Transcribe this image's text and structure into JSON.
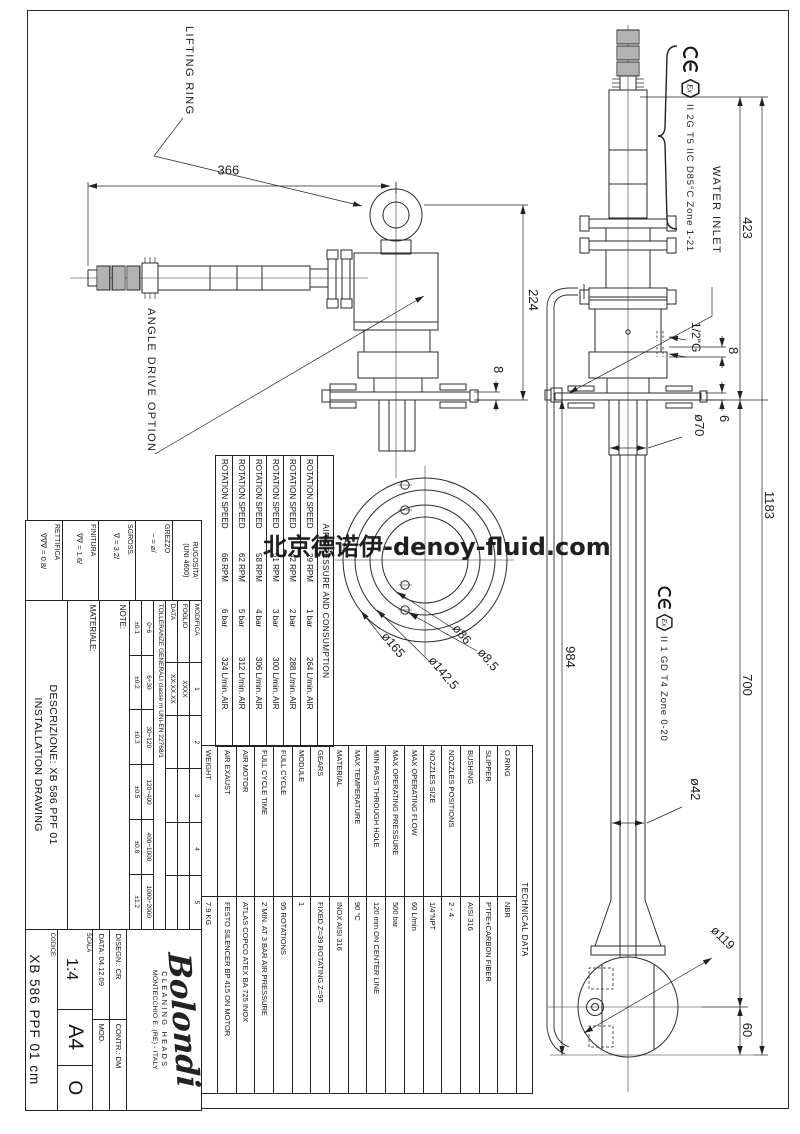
{
  "watermark": "北京德诺伊-denoy-fluid.com",
  "annotations": {
    "lifting_ring": "LIFTING RING",
    "angle_drive": "ANGLE DRIVE OPTION",
    "water_inlet": "WATER INLET",
    "atex_motor": "II 2G T5 IIC D85°C Zone 1-21",
    "atex_head": "II 1 GD T4 Zone 0-20",
    "ex_label": "Ex"
  },
  "dimensions": {
    "d1183": "1183",
    "d423": "423",
    "d700": "700",
    "d60": "60",
    "d984": "984",
    "d366": "366",
    "d224": "224",
    "d8l": "8",
    "d8r": "8",
    "d6": "6",
    "d70": "ø70",
    "g12": "1/2\"G",
    "d42": "ø42",
    "d119": "ø119",
    "d85": "ø8.5",
    "d86": "ø86",
    "d142": "ø142.5",
    "d165": "ø165"
  },
  "air_table": {
    "title": "AIR PRESSURE AND CONSUMPTION",
    "rows": [
      {
        "label": "ROTATION SPEED",
        "speed": "29 RPM",
        "pressure": "1 bar",
        "flow": "264 L/min. AIR"
      },
      {
        "label": "ROTATION SPEED",
        "speed": "42 RPM",
        "pressure": "2 bar",
        "flow": "288 L/min. AIR"
      },
      {
        "label": "ROTATION SPEED",
        "speed": "51 RPM",
        "pressure": "3 bar",
        "flow": "300 L/min. AIR"
      },
      {
        "label": "ROTATION SPEED",
        "speed": "58 RPM",
        "pressure": "4 bar",
        "flow": "306 L/min. AIR"
      },
      {
        "label": "ROTATION SPEED",
        "speed": "62 RPM",
        "pressure": "5 bar",
        "flow": "312 L/min. AIR"
      },
      {
        "label": "ROTATION SPEED",
        "speed": "66 RPM",
        "pressure": "6 bar",
        "flow": "324 L/min. AIR"
      }
    ]
  },
  "tech_table": {
    "title": "TECHNICAL DATA",
    "rows": [
      {
        "k": "O.RING",
        "v": "NBR"
      },
      {
        "k": "SLIPPER",
        "v": "PTFE+CARBON FIBER"
      },
      {
        "k": "BUSHING",
        "v": "AISI 316"
      },
      {
        "k": "NOZZLES POSITIONS",
        "v": "2 - 4"
      },
      {
        "k": "NOZZLES SIZE",
        "v": "1/4\"NPT"
      },
      {
        "k": "MAX OPERATING FLOW",
        "v": "60 L/min"
      },
      {
        "k": "MAX OPERATING PRESSURE",
        "v": "500 bar"
      },
      {
        "k": "MIN PASS THROUGH HOLE",
        "v": "120 mm ON CENTER LINE"
      },
      {
        "k": "MAX TEMPERATURE",
        "v": "90 °C"
      },
      {
        "k": "MATERIAL",
        "v": "INOX AISI 316"
      },
      {
        "k": "GEARS",
        "v": "FIXED Z=39 ROTATING Z=95"
      },
      {
        "k": "MODULE",
        "v": "1"
      },
      {
        "k": "FULL CYCLE",
        "v": "95 ROTATIONS"
      },
      {
        "k": "FULL CYCLE TIME",
        "v": "2 MIN. AT 3 BAR AIR PRESSURE"
      },
      {
        "k": "AIR MOTOR",
        "v": "ATLAS COPCO ATEX BA 725 INOX"
      },
      {
        "k": "AIR EXAUST",
        "v": "FESTO SILENCER BP 415 ON MOTOR"
      },
      {
        "k": "WEIGHT",
        "v": "7.9 KG"
      }
    ]
  },
  "title_block": {
    "rugosita": {
      "title": "RUGOSITA'",
      "subtitle": "(UNI 4600)",
      "rows": [
        {
          "name": "GREZZO",
          "value": "~ = ⌀/"
        },
        {
          "name": "SGROSS.",
          "value": "∇ = 3.2/"
        },
        {
          "name": "FINITURA",
          "value": "∇∇ = 1.6/"
        },
        {
          "name": "RETTIFICA",
          "value": "∇∇∇ = 0.8/"
        }
      ]
    },
    "revision": {
      "modifica": [
        "MODIFICA",
        "1",
        "2",
        "3",
        "4",
        "5"
      ],
      "foglio": [
        "FOGLIO",
        "XXXX",
        "",
        "",
        "",
        ""
      ],
      "data": [
        "DATA",
        "XX.XX.XX",
        "",
        "",
        "",
        ""
      ]
    },
    "tolerances": {
      "title": "TOLLERANZE GENERALI classe m UNI-EN 22768/1",
      "ranges": [
        "0÷6",
        "6÷30",
        "30÷120",
        "120÷400",
        "400÷1000",
        "1000÷2000"
      ],
      "values": [
        "±0.1",
        "±0.2",
        "±0.3",
        "±0.5",
        "±0.8",
        "±1.2"
      ]
    },
    "note_label": "NOTE:",
    "material_label": "MATERIALE:",
    "description_line1": "DESCRIZIONE: XB 586 PPF 01",
    "description_line2": "INSTALLATION DRAWING",
    "company": {
      "logo": "Bolondi",
      "tagline": "CLEANING HEADS",
      "address": "MONTECCHIO E. (RE) - ITALY",
      "drawn": "DISEGN.: CR",
      "checked": "CONTR.: DM",
      "date": "DATA: 04.12.09",
      "mod_label": "MOD.",
      "scale_label": "SCALA",
      "scale": "1:4",
      "format": "A4",
      "mod_value": "O",
      "code_label": "CODICE:",
      "code": "XB 586 PPF 01 cm"
    }
  }
}
